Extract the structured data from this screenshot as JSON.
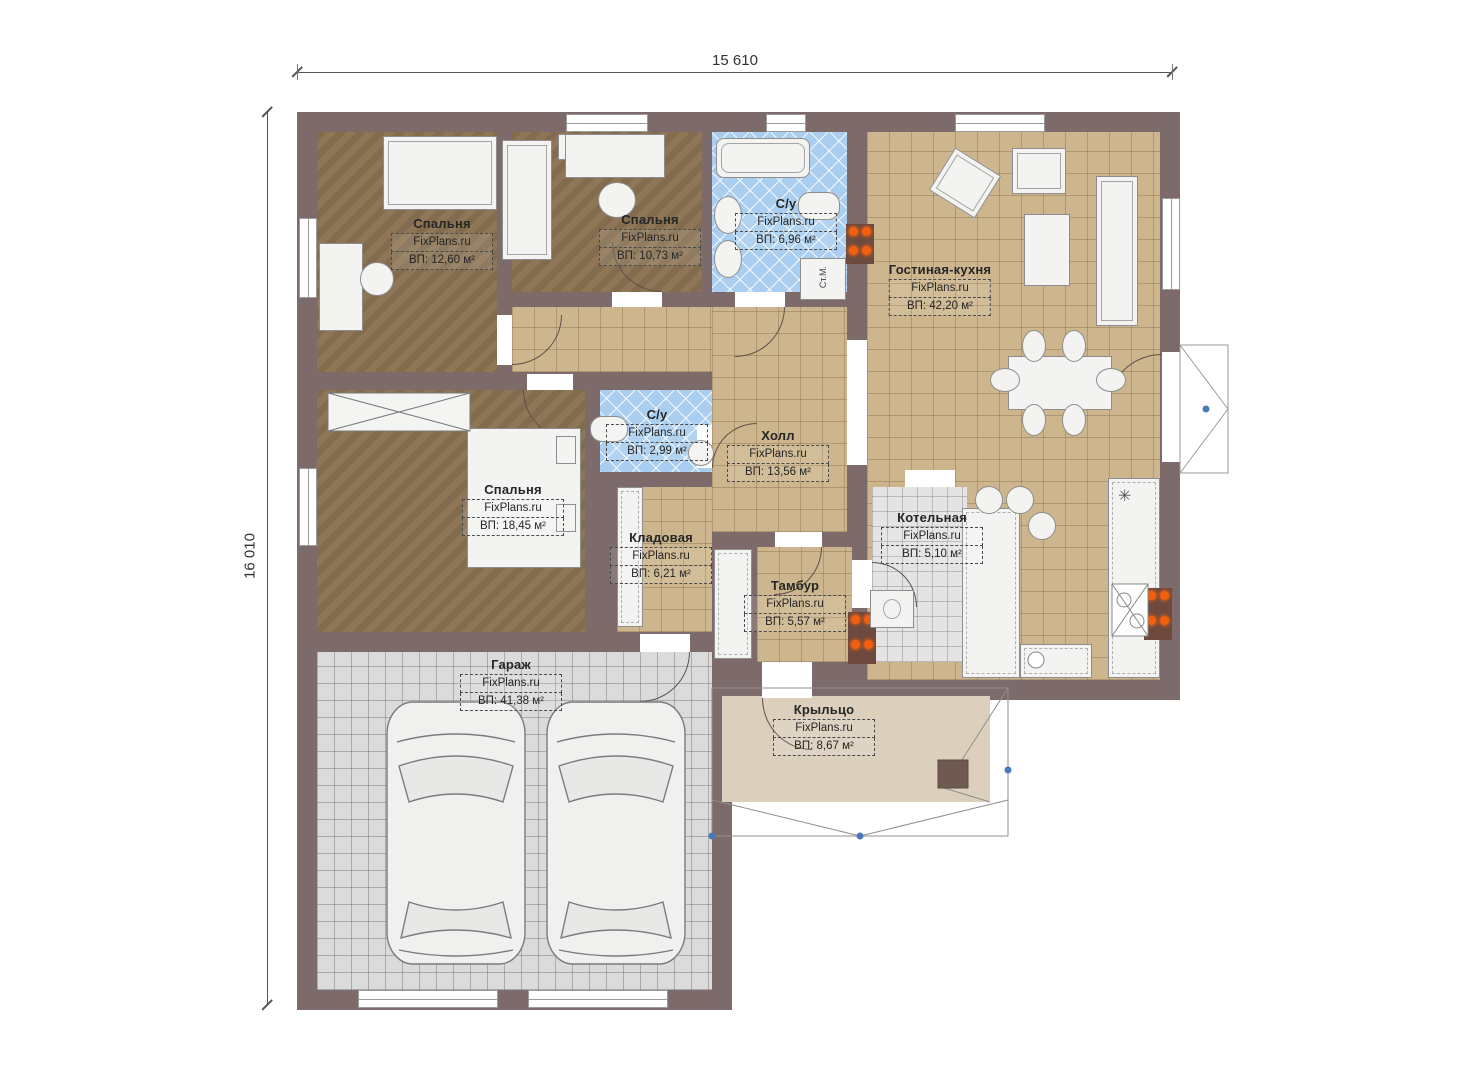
{
  "dimensions": {
    "width_label": "15 610",
    "height_label": "16 010"
  },
  "rooms": [
    {
      "id": "bedroom-1",
      "name": "Спальня",
      "watermark": "FixPlans.ru",
      "area": "ВП: 12,60 м²"
    },
    {
      "id": "bedroom-2",
      "name": "Спальня",
      "watermark": "FixPlans.ru",
      "area": "ВП: 10,73 м²"
    },
    {
      "id": "bathroom-1",
      "name": "С/у",
      "watermark": "FixPlans.ru",
      "area": "ВП: 6,96 м²"
    },
    {
      "id": "living-kitchen",
      "name": "Гостиная-кухня",
      "watermark": "FixPlans.ru",
      "area": "ВП: 42,20 м²"
    },
    {
      "id": "bathroom-2",
      "name": "С/у",
      "watermark": "FixPlans.ru",
      "area": "ВП: 2,99 м²"
    },
    {
      "id": "hall",
      "name": "Холл",
      "watermark": "FixPlans.ru",
      "area": "ВП: 13,56 м²"
    },
    {
      "id": "bedroom-3",
      "name": "Спальня",
      "watermark": "FixPlans.ru",
      "area": "ВП: 18,45 м²"
    },
    {
      "id": "storage",
      "name": "Кладовая",
      "watermark": "FixPlans.ru",
      "area": "ВП: 6,21 м²"
    },
    {
      "id": "boiler-room",
      "name": "Котельная",
      "watermark": "FixPlans.ru",
      "area": "ВП: 5,10 м²"
    },
    {
      "id": "tambour",
      "name": "Тамбур",
      "watermark": "FixPlans.ru",
      "area": "ВП: 5,57 м²"
    },
    {
      "id": "garage",
      "name": "Гараж",
      "watermark": "FixPlans.ru",
      "area": "ВП: 41,38 м²"
    },
    {
      "id": "porch",
      "name": "Крыльцо",
      "watermark": "FixPlans.ru",
      "area": "ВП: 8,67 м²"
    }
  ],
  "annotations": {
    "washing_machine_label": "Ст.М.",
    "fridge_symbol": "✳"
  },
  "colors": {
    "wall": "#7D6B6B",
    "bedroom_floor": "#8A7252",
    "tile_floor": "#CDB68E",
    "bath_tile": "#A9CEEF",
    "garage_tile": "#DBDBDB",
    "porch_floor": "#DCD0BD",
    "burner": "#F2600F"
  }
}
